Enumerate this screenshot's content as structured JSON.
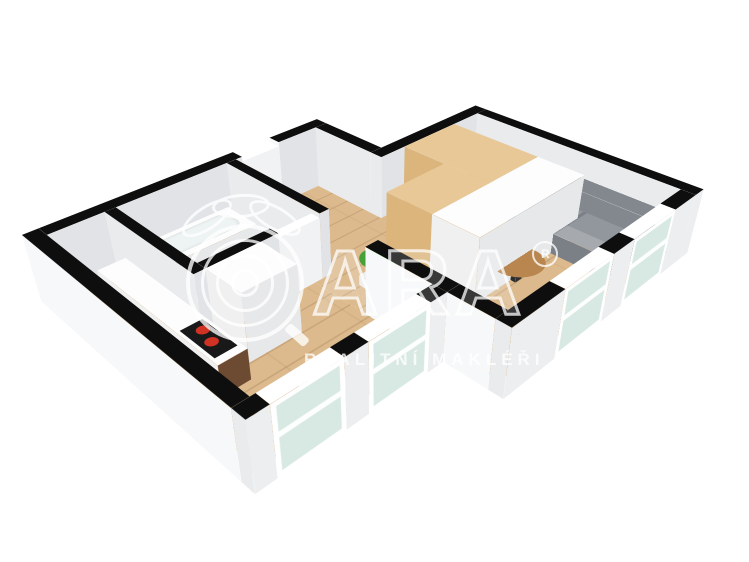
{
  "watermark": {
    "brand": "QARA",
    "brand_letters": "ARA",
    "registered": "®",
    "subtitle": "REALITNÍ MAKLÉŘI"
  },
  "palette": {
    "wallTop": "#0e0e0e",
    "extS": "#f7f8f9",
    "extE": "#eceef0",
    "intS": "#e9ebed",
    "intE": "#e1e3e6",
    "doorTop": "#ffffff",
    "doorFace": "#f1f2f3",
    "frame": "#ffffff",
    "glass": "#d8e9e3",
    "wood": "#dcba8d",
    "tile": "#cfbca7",
    "sofa": "#92979e",
    "sofaDark": "#83888f",
    "sofaSide": "#7b8087",
    "tableWood": "#b8864e",
    "legDark": "#2e2e2e",
    "leaf": "#46a238",
    "leafLight": "#63c04e",
    "potLight": "#ececec",
    "potShade": "#d8d8d8",
    "oakTop": "#e9c897",
    "oakS": "#dbb57c",
    "oakE": "#d0a86c",
    "whiteTop": "#fdfdfd",
    "whiteS": "#f0f0f1",
    "whiteE": "#e7e8e9",
    "walnut": "#6d4a32",
    "cooktop": "#191919",
    "burner": "#d03224",
    "metal": "#a6abb0",
    "white": "#ffffff",
    "basin": "#eef3f3"
  },
  "plan": {
    "wall_height": 75,
    "items": [
      {
        "n": "floor-living",
        "t": "flat",
        "x": 121,
        "y": 16,
        "w": 259,
        "d": 278,
        "c": "wood",
        "cls": "wood"
      },
      {
        "n": "floor-passage",
        "t": "flat",
        "x": 121,
        "y": 294,
        "w": 113,
        "d": 16,
        "c": "wood",
        "cls": "wood"
      },
      {
        "n": "floor-south-bay",
        "t": "flat",
        "x": 162,
        "y": 310,
        "w": 152,
        "d": 190,
        "c": "wood",
        "cls": "wood"
      },
      {
        "n": "floor-kitchen",
        "t": "flat",
        "x": 16,
        "y": 442,
        "w": 146,
        "d": 58,
        "c": "wood",
        "cls": "wood"
      },
      {
        "n": "floor-hall",
        "t": "flat",
        "x": 16,
        "y": 176,
        "w": 146,
        "d": 112,
        "c": "wood",
        "cls": "wood"
      },
      {
        "n": "floor-bathroom",
        "t": "flat",
        "x": 16,
        "y": 300,
        "w": 134,
        "d": 130,
        "c": "tile",
        "cls": "tile"
      },
      {
        "n": "wall-nw-upper",
        "t": "box",
        "x": 0,
        "y": 160,
        "w": 16,
        "d": 70,
        "h": 75,
        "ct": "wallTop",
        "cs": "extS",
        "ce": "intE"
      },
      {
        "n": "entry-door",
        "t": "box",
        "x": 0,
        "y": 230,
        "w": 16,
        "d": 50,
        "h": 70,
        "ct": "doorTop",
        "cs": "doorFace",
        "ce": "doorFace"
      },
      {
        "n": "wall-nw-lower",
        "t": "box",
        "x": 0,
        "y": 280,
        "w": 16,
        "d": 220,
        "h": 75,
        "ct": "wallTop",
        "cs": "extS",
        "ce": "intE"
      },
      {
        "n": "wall-hall-north",
        "t": "box",
        "x": 16,
        "y": 160,
        "w": 89,
        "d": 16,
        "h": 75,
        "ct": "wallTop",
        "cs": "intS",
        "ce": "intE"
      },
      {
        "n": "wall-living-west",
        "t": "box",
        "x": 105,
        "y": 0,
        "w": 16,
        "d": 176,
        "h": 75,
        "ct": "wallTop",
        "cs": "intS",
        "ce": "intE"
      },
      {
        "n": "wall-living-north",
        "t": "box",
        "x": 121,
        "y": 0,
        "w": 275,
        "d": 16,
        "h": 75,
        "ct": "wallTop",
        "cs": "intS",
        "ce": "extE"
      },
      {
        "n": "wall-bath-north",
        "t": "box",
        "x": 16,
        "y": 288,
        "w": 146,
        "d": 12,
        "h": 75,
        "ct": "wallTop",
        "cs": "intS",
        "ce": "intE"
      },
      {
        "n": "bath-door",
        "t": "box",
        "x": 150,
        "y": 300,
        "w": 12,
        "d": 50,
        "h": 70,
        "ct": "doorTop",
        "cs": "doorFace",
        "ce": "doorFace"
      },
      {
        "n": "wall-bath-east",
        "t": "box",
        "x": 150,
        "y": 350,
        "w": 12,
        "d": 80,
        "h": 75,
        "ct": "wallTop",
        "cs": "intS",
        "ce": "intE"
      },
      {
        "n": "wall-bath-south",
        "t": "box",
        "x": 16,
        "y": 430,
        "w": 146,
        "d": 12,
        "h": 75,
        "ct": "wallTop",
        "cs": "intS",
        "ce": "intE"
      },
      {
        "n": "closet-wood",
        "t": "box",
        "x": 121,
        "y": 58,
        "w": 117,
        "d": 82,
        "h": 75,
        "ct": "oakTop",
        "cs": "oakS",
        "ce": "oakE"
      },
      {
        "n": "closet-wood-arm",
        "t": "box",
        "x": 178,
        "y": 140,
        "w": 60,
        "d": 86,
        "h": 75,
        "ct": "oakTop",
        "cs": "oakS",
        "ce": "oakE"
      },
      {
        "n": "closet-white",
        "t": "box",
        "x": 238,
        "y": 58,
        "w": 58,
        "d": 168,
        "h": 75,
        "ct": "whiteTop",
        "cs": "whiteS",
        "ce": "whiteE"
      },
      {
        "n": "sofa-back",
        "t": "box",
        "x": 228,
        "y": 16,
        "w": 134,
        "d": 26,
        "h": 46,
        "ct": "sofaDark",
        "cs": "sofaDark",
        "ce": "sofaSide"
      },
      {
        "n": "sofa-seat",
        "t": "box",
        "x": 228,
        "y": 42,
        "w": 134,
        "d": 60,
        "h": 24,
        "ct": "sofa",
        "cs": "sofaSide",
        "ce": "sofaSide",
        "cls": "cushions"
      },
      {
        "n": "coffee-table-leg",
        "t": "box",
        "x": 292,
        "y": 160,
        "w": 10,
        "d": 10,
        "h": 20,
        "ct": "legDark",
        "cs": "legDark",
        "ce": "legDark"
      },
      {
        "n": "coffee-table-top",
        "t": "disc",
        "x": 270,
        "y": 138,
        "w": 56,
        "d": 56,
        "z": 22,
        "c": "tableWood"
      },
      {
        "n": "plant-pot",
        "t": "box",
        "x": 196,
        "y": 262,
        "w": 20,
        "d": 20,
        "h": 12,
        "ct": "potLight",
        "cs": "potLight",
        "ce": "potShade"
      },
      {
        "n": "plant-leaves-outer",
        "t": "disc",
        "x": 184,
        "y": 242,
        "w": 42,
        "d": 40,
        "z": 26,
        "c": "leaf"
      },
      {
        "n": "plant-leaves-inner",
        "t": "disc",
        "x": 198,
        "y": 254,
        "w": 30,
        "d": 28,
        "z": 34,
        "c": "leafLight"
      },
      {
        "n": "tall-unit",
        "t": "box",
        "x": 162,
        "y": 370,
        "w": 50,
        "d": 60,
        "h": 75,
        "ct": "whiteTop",
        "cs": "whiteS",
        "ce": "whiteE"
      },
      {
        "n": "bathtub",
        "t": "box",
        "x": 16,
        "y": 305,
        "w": 50,
        "d": 122,
        "h": 24,
        "ct": "whiteTop",
        "cs": "whiteS",
        "ce": "whiteE"
      },
      {
        "n": "bathtub-basin",
        "t": "flat",
        "x": 24,
        "y": 315,
        "w": 34,
        "d": 102,
        "z": 25,
        "c": "basin",
        "cls": "rounded soft"
      },
      {
        "n": "bath-sink",
        "t": "box",
        "x": 46,
        "y": 398,
        "w": 66,
        "d": 32,
        "h": 26,
        "ct": "whiteTop",
        "cs": "whiteS",
        "ce": "whiteE"
      },
      {
        "n": "faucet",
        "t": "box",
        "x": 72,
        "y": 402,
        "w": 6,
        "d": 6,
        "h": 34,
        "ct": "metal",
        "cs": "metal",
        "ce": "metal"
      },
      {
        "n": "toilet",
        "t": "box",
        "x": 116,
        "y": 392,
        "w": 30,
        "d": 30,
        "h": 16,
        "ct": "whiteTop",
        "cs": "whiteS",
        "ce": "whiteE"
      },
      {
        "n": "toilet-seat",
        "t": "disc",
        "x": 114,
        "y": 390,
        "w": 32,
        "d": 28,
        "z": 18,
        "c": "white"
      },
      {
        "n": "kitchen-counter",
        "t": "box",
        "x": 40,
        "y": 442,
        "w": 190,
        "d": 30,
        "h": 34,
        "ct": "whiteTop",
        "cs": "whiteS",
        "ce": "walnut"
      },
      {
        "n": "cooktop",
        "t": "flat",
        "x": 172,
        "y": 446,
        "w": 50,
        "d": 23,
        "z": 35,
        "c": "cooktop"
      },
      {
        "n": "burner-1",
        "t": "disc",
        "x": 180,
        "y": 449,
        "w": 12,
        "d": 12,
        "z": 36,
        "c": "burner"
      },
      {
        "n": "burner-2",
        "t": "disc",
        "x": 198,
        "y": 453,
        "w": 12,
        "d": 12,
        "z": 36,
        "c": "burner"
      },
      {
        "n": "radiator",
        "t": "box",
        "x": 272,
        "y": 398,
        "w": 40,
        "d": 26,
        "h": 20,
        "ct": "whiteTop",
        "cs": "whiteS",
        "ce": "whiteE"
      },
      {
        "n": "window-sill-box",
        "t": "box",
        "x": 286,
        "y": 314,
        "w": 26,
        "d": 18,
        "h": 14,
        "ct": "whiteTop",
        "cs": "whiteS",
        "ce": "whiteE"
      },
      {
        "n": "wall-living-south-stub",
        "t": "box",
        "x": 234,
        "y": 294,
        "w": 96,
        "d": 16,
        "h": 75,
        "ct": "wallTop",
        "cs": "extS",
        "ce": "intE"
      },
      {
        "n": "wall-step-south",
        "t": "box",
        "x": 330,
        "y": 294,
        "w": 50,
        "d": 16,
        "h": 75,
        "ct": "wallTop",
        "cs": "extS",
        "ce": "intE"
      },
      {
        "n": "wall-e-1",
        "t": "box",
        "x": 380,
        "y": 16,
        "w": 16,
        "d": 40,
        "h": 75,
        "ct": "wallTop",
        "cs": "intS",
        "ce": "extE"
      },
      {
        "n": "window-living-1",
        "t": "box",
        "x": 380,
        "y": 56,
        "w": 16,
        "d": 74,
        "h": 75,
        "ct": "frame",
        "cs": "frame",
        "ce": "glass",
        "glass": true
      },
      {
        "n": "wall-e-2",
        "t": "box",
        "x": 380,
        "y": 130,
        "w": 16,
        "d": 34,
        "h": 75,
        "ct": "wallTop",
        "cs": "intS",
        "ce": "extE"
      },
      {
        "n": "window-living-2",
        "t": "box",
        "x": 380,
        "y": 164,
        "w": 16,
        "d": 74,
        "h": 75,
        "ct": "frame",
        "cs": "frame",
        "ce": "glass",
        "glass": true
      },
      {
        "n": "wall-e-3",
        "t": "box",
        "x": 380,
        "y": 238,
        "w": 16,
        "d": 72,
        "h": 75,
        "ct": "wallTop",
        "cs": "intS",
        "ce": "extE"
      },
      {
        "n": "wall-se-1",
        "t": "box",
        "x": 314,
        "y": 310,
        "w": 16,
        "d": 20,
        "h": 75,
        "ct": "wallTop",
        "cs": "intS",
        "ce": "extE"
      },
      {
        "n": "window-bay-1",
        "t": "box",
        "x": 314,
        "y": 330,
        "w": 16,
        "d": 70,
        "h": 75,
        "ct": "frame",
        "cs": "frame",
        "ce": "glass",
        "glass": true
      },
      {
        "n": "wall-se-2",
        "t": "box",
        "x": 314,
        "y": 400,
        "w": 16,
        "d": 25,
        "h": 75,
        "ct": "wallTop",
        "cs": "intS",
        "ce": "extE"
      },
      {
        "n": "window-bay-2",
        "t": "box",
        "x": 314,
        "y": 425,
        "w": 16,
        "d": 70,
        "h": 75,
        "ct": "frame",
        "cs": "frame",
        "ce": "glass",
        "glass": true
      },
      {
        "n": "wall-se-3",
        "t": "box",
        "x": 314,
        "y": 495,
        "w": 16,
        "d": 21,
        "h": 75,
        "ct": "wallTop",
        "cs": "intS",
        "ce": "extE"
      },
      {
        "n": "wall-south",
        "t": "box",
        "x": 0,
        "y": 500,
        "w": 314,
        "d": 16,
        "h": 75,
        "ct": "wallTop",
        "cs": "extS",
        "ce": "extE"
      }
    ]
  }
}
